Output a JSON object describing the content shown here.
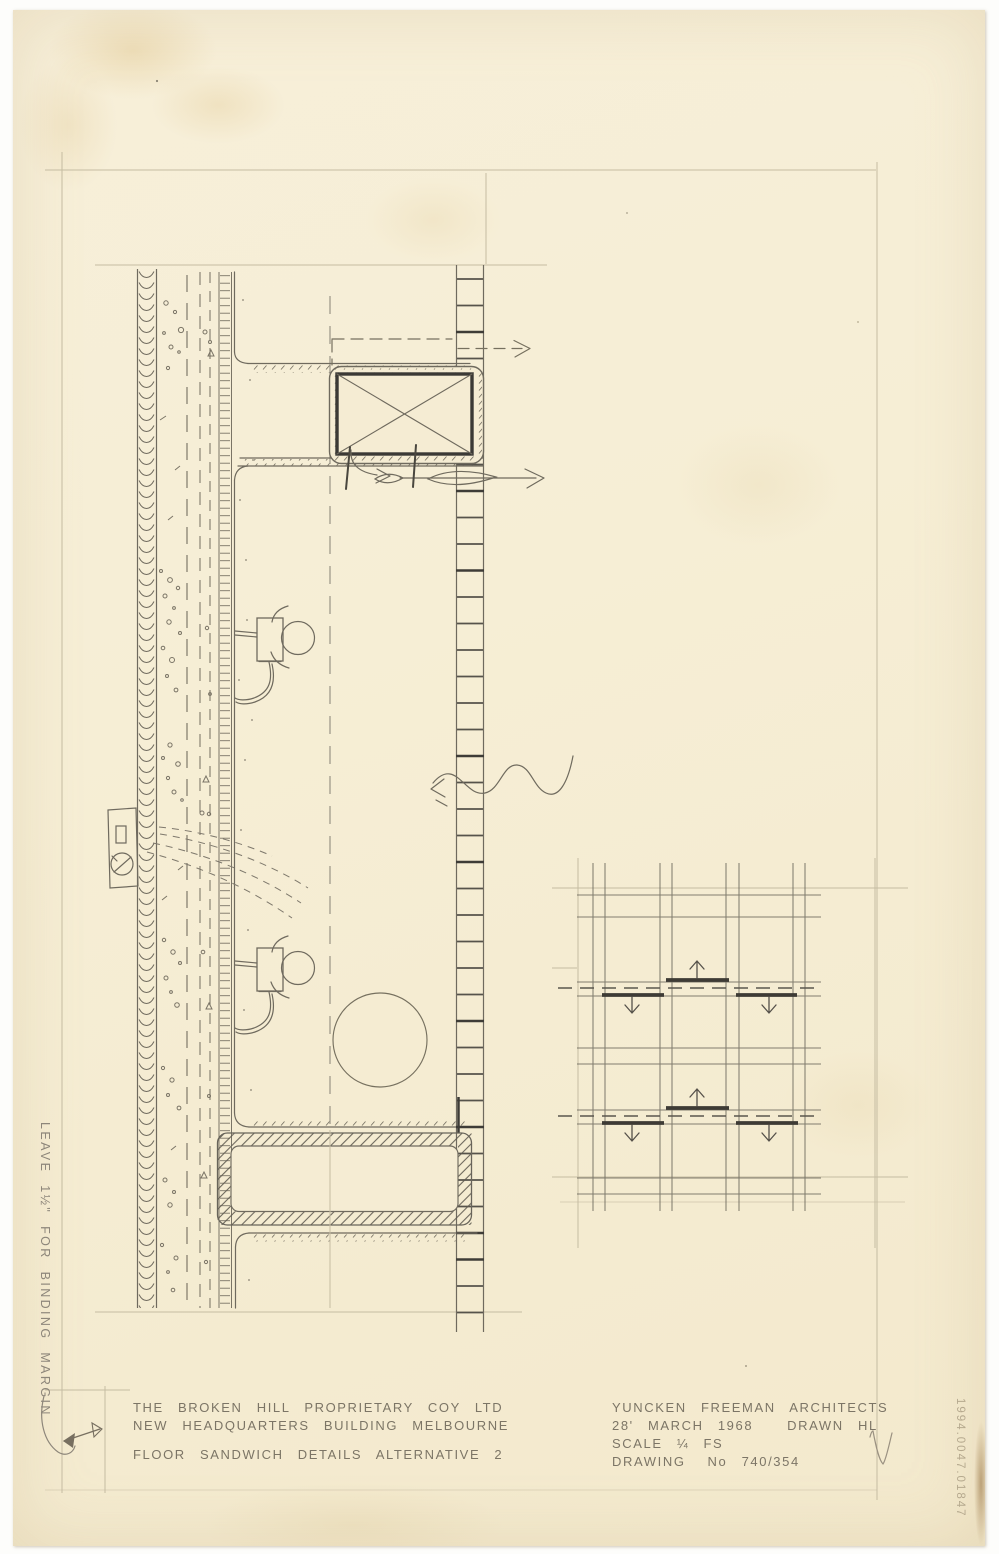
{
  "sheet": {
    "client_line1": "THE BROKEN HILL PROPRIETARY COY LTD",
    "client_line2": "NEW HEADQUARTERS BUILDING MELBOURNE",
    "drawing_title": "FLOOR SANDWICH DETAILS ALTERNATIVE 2",
    "firm": "YUNCKEN FREEMAN ARCHITECTS",
    "date": "28' MARCH 1968",
    "drawn": "DRAWN HL",
    "scale": "SCALE ¼ FS",
    "drawing_label": "DRAWING",
    "drawing_number": "No 740/354",
    "margin_note": "LEAVE 1½\" FOR BINDING MARGIN",
    "accession_number": "1994.0047.01847"
  },
  "colors": {
    "paper": "#f6eed6",
    "pencil": "#6f6a5e",
    "pencil_dark": "#3e3b36",
    "pencil_faint": "#c5bca2"
  }
}
